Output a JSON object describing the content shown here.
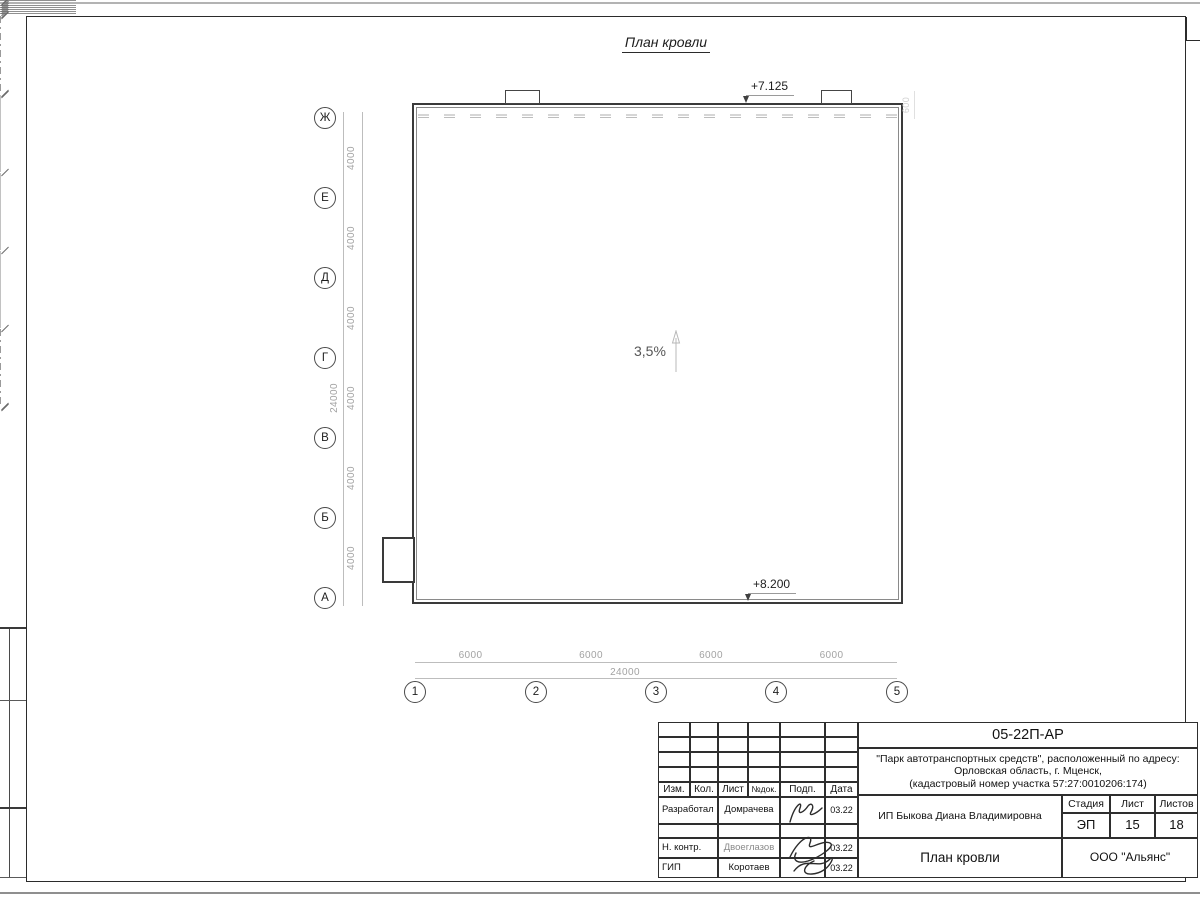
{
  "drawing": {
    "title": "План кровли",
    "slope_label": "3,5%",
    "elevation_top": "+7.125",
    "elevation_bottom": "+8.200",
    "parapet_dim": "600",
    "axes_vertical": [
      "Ж",
      "Е",
      "Д",
      "Г",
      "В",
      "Б",
      "А"
    ],
    "axes_horizontal": [
      "1",
      "2",
      "3",
      "4",
      "5"
    ],
    "dim_vertical_segments": [
      "4000",
      "4000",
      "4000",
      "4000",
      "4000",
      "4000"
    ],
    "dim_vertical_total": "24000",
    "dim_horizontal_segments": [
      "6000",
      "6000",
      "6000",
      "6000"
    ],
    "dim_horizontal_total": "24000"
  },
  "title_block": {
    "doc_code": "05-22П-АР",
    "project_line1": "\"Парк автотранспортных средств\",  расположенный по адресу:",
    "project_line2": "Орловская область, г. Мценск,",
    "project_line3": "(кадастровый номер участка 57:27:0010206:174)",
    "client": "ИП Быкова Диана Владимировна",
    "sheet_title": "План кровли",
    "organization": "ООО \"Альянс\"",
    "header_cols": [
      "Изм.",
      "Кол.",
      "Лист",
      "№док.",
      "Подп.",
      "Дата"
    ],
    "stage_label": "Стадия",
    "sheet_label": "Лист",
    "sheets_label": "Листов",
    "stage": "ЭП",
    "sheet": "15",
    "sheets": "18",
    "rows": [
      {
        "role": "Разработал",
        "name": "Домрачева",
        "date": "03.22"
      },
      {
        "role": "Н. контр.",
        "name": "Двоеглазов",
        "date": "03.22"
      },
      {
        "role": "ГИП",
        "name": "Коротаев",
        "date": "03.22"
      }
    ]
  },
  "colors": {
    "ink": "#1d1d1d",
    "wall": "#3a3a3a",
    "dim": "#a3a3a3",
    "dash": "#c4c4c4"
  }
}
